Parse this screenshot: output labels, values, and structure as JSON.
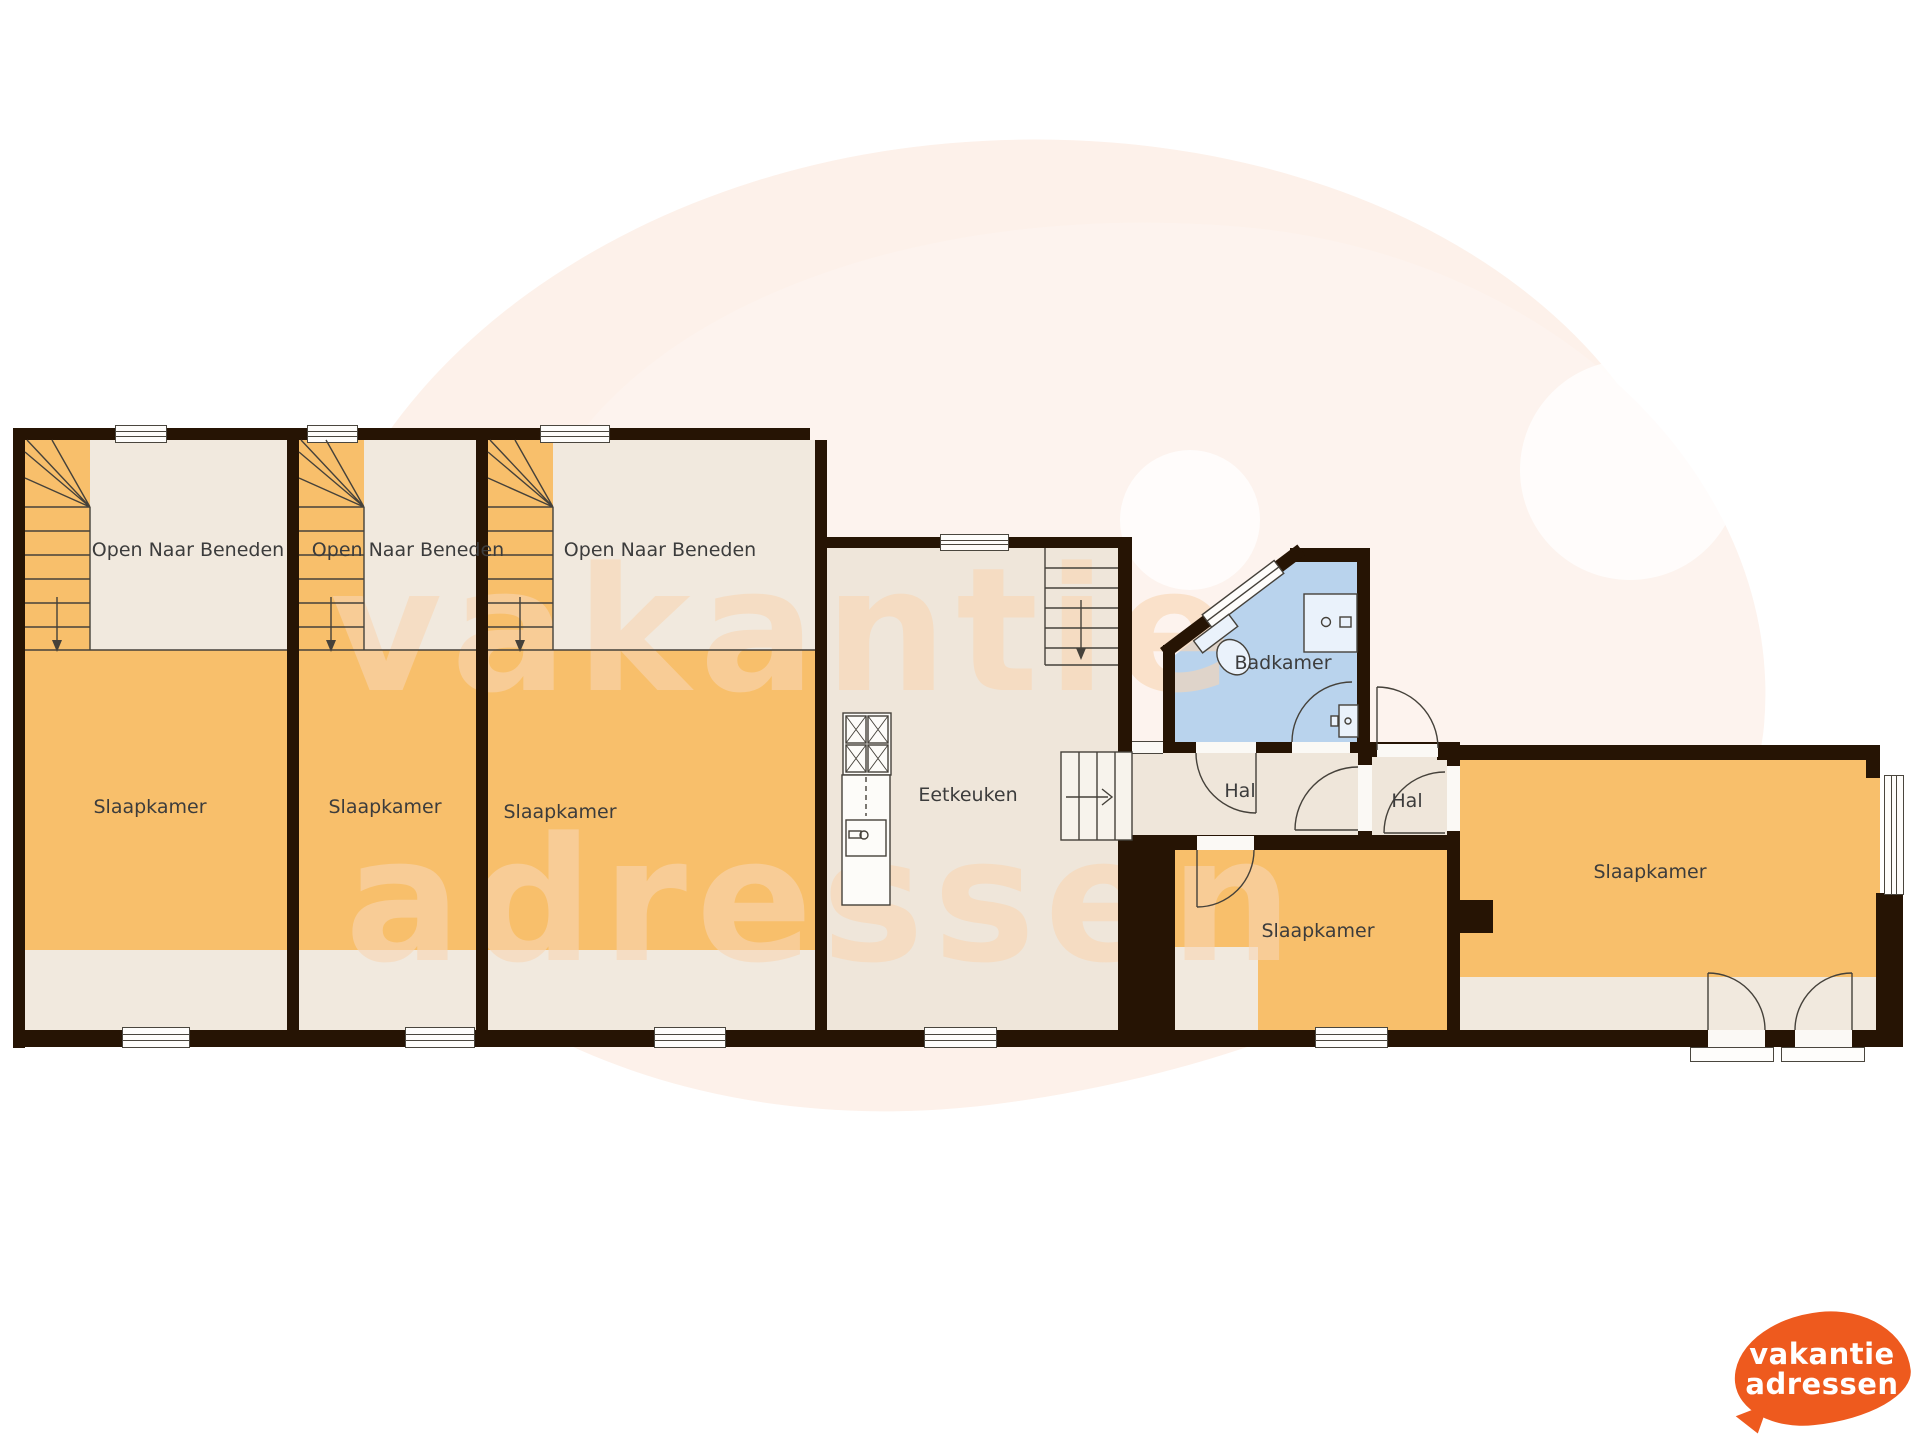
{
  "labels": {
    "open_naar_beneden": "Open Naar Beneden",
    "slaapkamer": "Slaapkamer",
    "eetkeuken": "Eetkeuken",
    "badkamer": "Badkamer",
    "hal": "Hal"
  },
  "rooms": [
    {
      "name": "bedroom-left-1",
      "label": "Slaapkamer"
    },
    {
      "name": "bedroom-left-2",
      "label": "Slaapkamer"
    },
    {
      "name": "bedroom-left-3",
      "label": "Slaapkamer"
    },
    {
      "name": "void-1",
      "label": "Open Naar Beneden"
    },
    {
      "name": "void-2",
      "label": "Open Naar Beneden"
    },
    {
      "name": "void-3",
      "label": "Open Naar Beneden"
    },
    {
      "name": "kitchen",
      "label": "Eetkeuken"
    },
    {
      "name": "bathroom",
      "label": "Badkamer"
    },
    {
      "name": "hall-1",
      "label": "Hal"
    },
    {
      "name": "hall-2",
      "label": "Hal"
    },
    {
      "name": "bedroom-middle",
      "label": "Slaapkamer"
    },
    {
      "name": "bedroom-right",
      "label": "Slaapkamer"
    }
  ],
  "watermark": {
    "line1": "vakantie",
    "line2": "adressen"
  },
  "logo": {
    "line1": "vakantie",
    "line2": "adressen"
  },
  "colors": {
    "wall": "#261404",
    "floor_orange": "#f8bf6b",
    "floor_beige": "#f1e9de",
    "bathroom_blue": "#b9d3ed",
    "background_blob": "#fdf1ea",
    "watermark_text": "#f8d6b2",
    "logo_orange": "#ee5a1e"
  }
}
